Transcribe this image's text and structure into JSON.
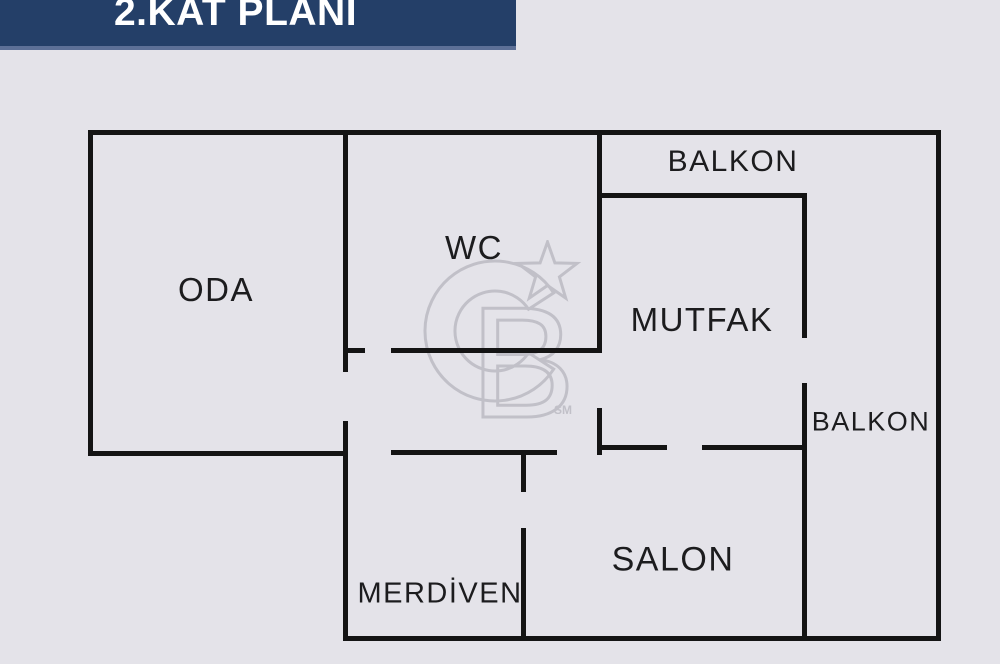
{
  "header": {
    "title": "2.KAT PLANI"
  },
  "floorplan": {
    "rooms": [
      {
        "id": "oda",
        "label": "ODA"
      },
      {
        "id": "wc",
        "label": "WC"
      },
      {
        "id": "balkon-top",
        "label": "BALKON"
      },
      {
        "id": "mutfak",
        "label": "MUTFAK"
      },
      {
        "id": "balkon-right",
        "label": "BALKON"
      },
      {
        "id": "salon",
        "label": "SALON"
      },
      {
        "id": "merdiven",
        "label": "MERDİVEN"
      }
    ],
    "colors": {
      "background": "#e4e3e9",
      "banner": "#243f68",
      "banner_edge": "#5d7097",
      "wall": "#141414",
      "label": "#1c1c1e",
      "watermark": "#c1c0c8"
    },
    "walls": [
      {
        "name": "wall-outer-top",
        "x": 88,
        "y": 130,
        "w": 853,
        "h": 5
      },
      {
        "name": "wall-outer-left",
        "x": 88,
        "y": 130,
        "w": 5,
        "h": 326
      },
      {
        "name": "wall-oda-bottom",
        "x": 88,
        "y": 451,
        "w": 260,
        "h": 5
      },
      {
        "name": "wall-mid-vertical-upper",
        "x": 343,
        "y": 130,
        "w": 5,
        "h": 242
      },
      {
        "name": "wall-mid-vertical-lower",
        "x": 343,
        "y": 421,
        "w": 5,
        "h": 220
      },
      {
        "name": "wall-outer-bottom",
        "x": 343,
        "y": 636,
        "w": 598,
        "h": 5
      },
      {
        "name": "wall-outer-right",
        "x": 936,
        "y": 130,
        "w": 5,
        "h": 511
      },
      {
        "name": "wall-wc-mutfak-divider",
        "x": 597,
        "y": 130,
        "w": 5,
        "h": 222
      },
      {
        "name": "wall-wc-bottom-stub",
        "x": 343,
        "y": 348,
        "w": 22,
        "h": 5
      },
      {
        "name": "wall-wc-bottom",
        "x": 391,
        "y": 348,
        "w": 211,
        "h": 5
      },
      {
        "name": "wall-balkon-top-bottom",
        "x": 600,
        "y": 193,
        "w": 207,
        "h": 5
      },
      {
        "name": "wall-mutfak-right",
        "x": 802,
        "y": 193,
        "w": 5,
        "h": 145
      },
      {
        "name": "wall-salon-right",
        "x": 802,
        "y": 383,
        "w": 5,
        "h": 258
      },
      {
        "name": "wall-hall-bottom",
        "x": 391,
        "y": 450,
        "w": 166,
        "h": 5
      },
      {
        "name": "wall-hall-stub-vertical",
        "x": 597,
        "y": 408,
        "w": 5,
        "h": 47
      },
      {
        "name": "wall-salon-top-left",
        "x": 597,
        "y": 445,
        "w": 70,
        "h": 5
      },
      {
        "name": "wall-salon-top-right",
        "x": 702,
        "y": 445,
        "w": 105,
        "h": 5
      },
      {
        "name": "wall-merdiven-right-upper",
        "x": 521,
        "y": 453,
        "w": 5,
        "h": 39
      },
      {
        "name": "wall-merdiven-right-lower",
        "x": 521,
        "y": 528,
        "w": 5,
        "h": 113
      }
    ]
  },
  "watermark": {
    "letter_b": "B",
    "subscript": "SM"
  }
}
